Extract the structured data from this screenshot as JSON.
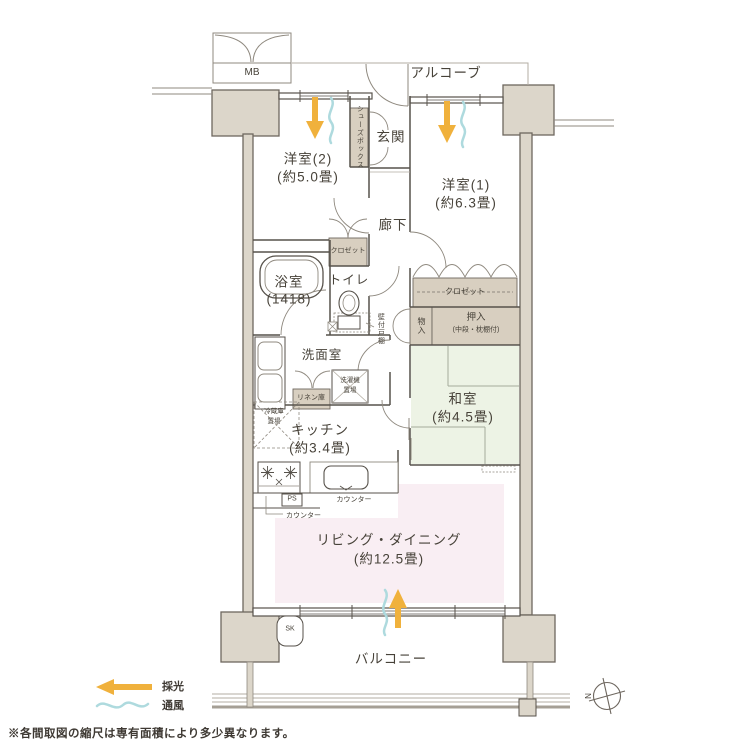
{
  "plan": {
    "rooms": {
      "western2": {
        "name": "洋室(2)",
        "size": "(約5.0畳)"
      },
      "western1": {
        "name": "洋室(1)",
        "size": "(約6.3畳)"
      },
      "japanese": {
        "name": "和室",
        "size": "(約4.5畳)"
      },
      "kitchen": {
        "name": "キッチン",
        "size": "(約3.4畳)"
      },
      "living_dining": {
        "name": "リビング・ダイニング",
        "size": "(約12.5畳)"
      },
      "bath": {
        "name": "浴室",
        "size": "(1418)"
      },
      "toilet": "トイレ",
      "washroom": "洗面室",
      "entrance": "玄関",
      "hallway": "廊下",
      "balcony": "バルコニー",
      "alcove": "アルコーブ"
    },
    "storage": {
      "shoes_box": "シューズボックス",
      "closet_west2": "クロゼット",
      "closet_west1": "クロゼット",
      "oshiire": {
        "name": "押入",
        "note": "(中段・枕棚付)"
      },
      "storage_small": "物入",
      "wall_cabinet": "壁付戸棚",
      "linen": "リネン庫",
      "washer_space": {
        "line1": "洗濯機",
        "line2": "置場"
      },
      "fridge_space": {
        "line1": "冷蔵庫",
        "line2": "置場"
      }
    },
    "fixtures": {
      "meter_box": "MB",
      "pipe_space": "PS",
      "slop_sink": "SK",
      "counter_kitchen": "カウンター",
      "counter_hall": "カウンター"
    },
    "legend": {
      "daylight": "採光",
      "ventilation": "通風"
    },
    "compass": {
      "north": "N"
    },
    "footnote": "※各間取図の縮尺は専有面積により多少異なります。",
    "colors": {
      "wall_fill": "#dcd6ca",
      "storage_fill": "#d8cfc0",
      "tatami": "#edf3e5",
      "living_pink": "#f9eef3",
      "daylight_arrow": "#f0b13c",
      "ventilation_wave": "#aedade"
    }
  }
}
